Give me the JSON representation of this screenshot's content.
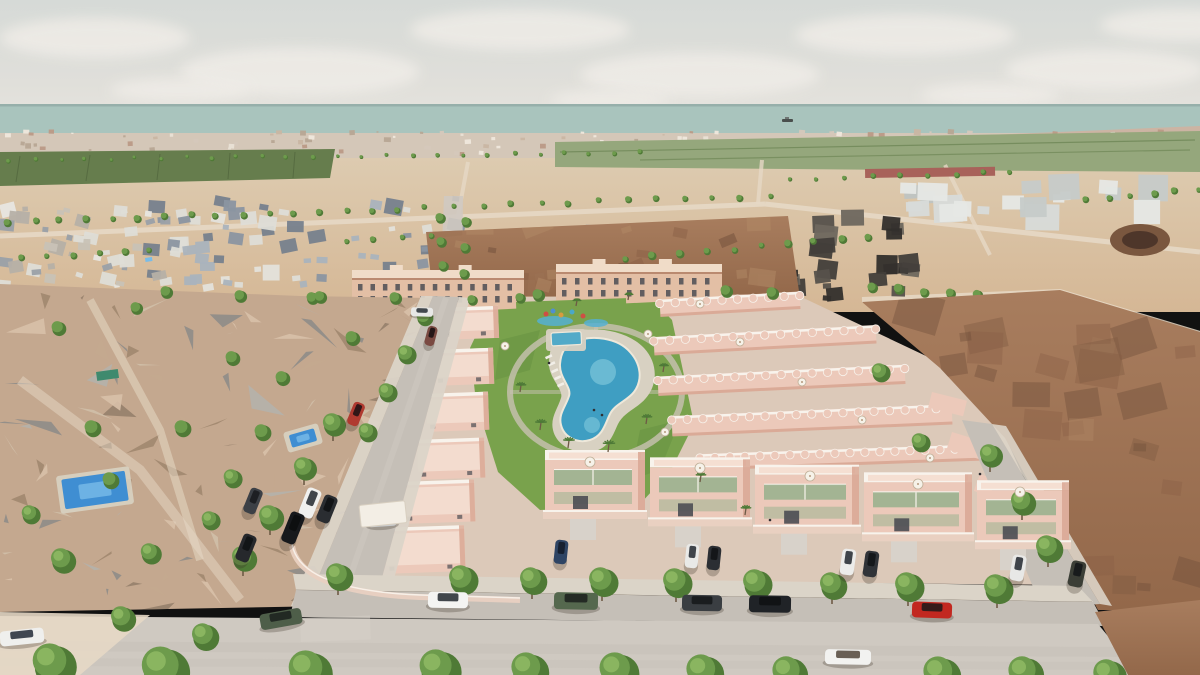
{
  "scene": {
    "type": "aerial-3d-render",
    "subject": "coastal residential development with lagoon pool, old town, sea horizon"
  },
  "palette": {
    "sky_top": "#d6dad7",
    "sky_bot": "#e9e6e0",
    "cloud": "#efece7",
    "sea": "#a9c4bd",
    "sea_dark": "#96afaa",
    "ship": "#4a4f4d",
    "town": "#d4c7b8",
    "hill": "#ccb4a3",
    "field": "#95a77c",
    "field_dark": "#6f8757",
    "orchard": "#667d4d",
    "orchard_dark": "#50643c",
    "sand_light": "#ddcbb0",
    "sand_mid": "#d5b795",
    "sand_road": "#e6d8c5",
    "warehouse": "#e6e8e5",
    "industrial": "#56514b",
    "redbldg": "#a8625a",
    "white_wall": "#deddd7",
    "grey_roof": "#8b95a1",
    "oldtown": "#c4a88f",
    "oldtown_light": "#d8c0a9",
    "oldtown_dark": "#a1876f",
    "pool_old": "#3f8ed2",
    "pool_old_light": "#79bce8",
    "lagoon": "#3f9ec2",
    "lagoon_light": "#8ed2e2",
    "pool_small": "#52aac8",
    "lawn": "#79a24c",
    "lawn_dark": "#5f8a3c",
    "palm": "#4e7a37",
    "villa": "#ecc9ba",
    "villa_light": "#f5dfd2",
    "villa_shade": "#d9a794",
    "villa_trim": "#f8f3ec",
    "shutter": "#9cb28f",
    "fence": "#e9d0c1",
    "apt": "#e3bfa5",
    "apt_roof": "#ba8a70",
    "apt_light": "#f0dcc8",
    "win": "#4b4c53",
    "path": "#c9c2b3",
    "deck": "#d8d1c2",
    "plate": "#dcc9b9",
    "road": "#c5bfb7",
    "road_light": "#cfc9c1",
    "road_pale": "#d8d2ca",
    "curb": "#6b5e50",
    "sidewalk": "#dbd4c8",
    "dirt": "#a87d5e",
    "dirt_dark": "#7d5940",
    "dirt_light": "#bb9573",
    "tree": "#6d9b4c",
    "tree_dark": "#4f7a36",
    "tree_light": "#8fba64",
    "trunk": "#6e5a45"
  },
  "sky": {
    "clouds": [
      {
        "x": 95,
        "y": 38,
        "rx": 95,
        "ry": 20
      },
      {
        "x": 300,
        "y": 72,
        "rx": 120,
        "ry": 24
      },
      {
        "x": 520,
        "y": 30,
        "rx": 110,
        "ry": 20
      },
      {
        "x": 700,
        "y": 75,
        "rx": 120,
        "ry": 22
      },
      {
        "x": 905,
        "y": 35,
        "rx": 110,
        "ry": 20
      },
      {
        "x": 1105,
        "y": 70,
        "rx": 100,
        "ry": 20
      },
      {
        "x": 1180,
        "y": 25,
        "rx": 80,
        "ry": 16
      },
      {
        "x": 180,
        "y": 90,
        "rx": 70,
        "ry": 12
      },
      {
        "x": 610,
        "y": 100,
        "rx": 60,
        "ry": 10
      },
      {
        "x": 990,
        "y": 95,
        "rx": 70,
        "ry": 12
      }
    ]
  },
  "sea": {
    "ship": {
      "x": 782,
      "y": 119
    }
  },
  "clusters": [
    {
      "layer": "town-cluster",
      "x": 0,
      "y": 131,
      "w": 1200,
      "h": 25,
      "count": 140,
      "smin": 2,
      "smax": 7,
      "rot": 6,
      "seed": 11,
      "op": 0.95,
      "colors": [
        "#e9e1d5",
        "#c9b6a2",
        "#bb9a86",
        "#efe8dc",
        "#b7a694",
        "#d5c8ba"
      ]
    },
    {
      "layer": "white-cluster",
      "x": 2,
      "y": 206,
      "w": 168,
      "h": 100,
      "count": 55,
      "smin": 5,
      "smax": 16,
      "rot": 18,
      "seed": 23,
      "op": 0.95,
      "colors": [
        "#deddd7",
        "#9aa0a8",
        "#c8c2b6",
        "#e8e6e0",
        "#b6b0a6"
      ]
    },
    {
      "layer": "greyL-cluster",
      "x": 150,
      "y": 198,
      "w": 310,
      "h": 96,
      "count": 70,
      "smin": 6,
      "smax": 18,
      "rot": 12,
      "seed": 5,
      "op": 0.95,
      "colors": [
        "#deddd7",
        "#8b95a1",
        "#aab3bd",
        "#e4e2db",
        "#77818d"
      ]
    },
    {
      "layer": "greyC-cluster",
      "x": 540,
      "y": 228,
      "w": 245,
      "h": 62,
      "count": 45,
      "smin": 6,
      "smax": 15,
      "rot": 10,
      "seed": 31,
      "op": 0.95,
      "colors": [
        "#8b95a1",
        "#deddd7",
        "#9aa3ae",
        "#e2e0d9"
      ]
    },
    {
      "layer": "industrial-cluster",
      "x": 778,
      "y": 212,
      "w": 134,
      "h": 92,
      "count": 26,
      "smin": 8,
      "smax": 26,
      "rot": 8,
      "seed": 41,
      "op": 0.95,
      "colors": [
        "#56514b",
        "#332f2c",
        "#6e675e",
        "#423e3a"
      ]
    },
    {
      "layer": "warehouse-cluster",
      "x": 880,
      "y": 184,
      "w": 312,
      "h": 36,
      "count": 22,
      "smin": 10,
      "smax": 34,
      "rot": 4,
      "seed": 53,
      "op": 0.95,
      "colors": [
        "#e6e8e5",
        "#c6cbc9",
        "#d8dbd9",
        "#bfc4c2"
      ]
    },
    {
      "layer": "dirthill-tex",
      "x": 430,
      "y": 222,
      "w": 360,
      "h": 74,
      "count": 26,
      "smin": 8,
      "smax": 30,
      "rot": 25,
      "seed": 67,
      "op": 0.5,
      "colors": [
        "#8a6045",
        "#6f4e39",
        "#b28a66",
        "#9b7154"
      ]
    },
    {
      "layer": "dirtfield-tex",
      "x": 880,
      "y": 310,
      "w": 320,
      "h": 300,
      "count": 40,
      "smin": 10,
      "smax": 46,
      "rot": 20,
      "seed": 79,
      "op": 0.4,
      "colors": [
        "#8a6045",
        "#6f4e39",
        "#b28a66",
        "#7d5940"
      ]
    }
  ],
  "oldtown": {
    "facets": {
      "count": 120,
      "seed": 97,
      "x": 0,
      "y": 288,
      "w": 440,
      "h": 326,
      "smin": 8,
      "smax": 26,
      "colors": [
        "#d8c0a9",
        "#a1876f",
        "#c4a88f",
        "#b5b1ab",
        "#8f8c88",
        "#d0bfa9",
        "#96806c"
      ]
    },
    "pools": [
      {
        "x": 95,
        "y": 490,
        "w": 64,
        "h": 30,
        "rot": -8
      },
      {
        "x": 303,
        "y": 438,
        "w": 26,
        "h": 13,
        "rot": -16
      }
    ],
    "awning": {
      "x": 96,
      "y": 372,
      "w": 22,
      "h": 9,
      "rot": -8
    }
  },
  "apartments": [
    {
      "x": 352,
      "y": 270,
      "w": 172,
      "rows": 2,
      "cols": 13
    },
    {
      "x": 556,
      "y": 264,
      "w": 166,
      "rows": 2,
      "cols": 12
    }
  ],
  "villa_rows": [
    {
      "x1": 660,
      "y1": 308,
      "x2": 800,
      "y2": 300,
      "w": 17
    },
    {
      "x1": 654,
      "y1": 346,
      "x2": 876,
      "y2": 334,
      "w": 18
    },
    {
      "x1": 658,
      "y1": 386,
      "x2": 905,
      "y2": 374,
      "w": 19
    },
    {
      "x1": 672,
      "y1": 426,
      "x2": 952,
      "y2": 414,
      "w": 20
    },
    {
      "x1": 700,
      "y1": 462,
      "x2": 985,
      "y2": 452,
      "w": 16
    }
  ],
  "left_villas": [
    {
      "x": 436,
      "y": 308,
      "w": 62,
      "h": 32
    },
    {
      "x": 429,
      "y": 350,
      "w": 64,
      "h": 36
    },
    {
      "x": 421,
      "y": 394,
      "w": 67,
      "h": 38
    },
    {
      "x": 412,
      "y": 440,
      "w": 72,
      "h": 40
    },
    {
      "x": 398,
      "y": 482,
      "w": 76,
      "h": 42
    },
    {
      "x": 380,
      "y": 528,
      "w": 84,
      "h": 46
    }
  ],
  "front_units": [
    {
      "x": 545,
      "w": 100
    },
    {
      "x": 650,
      "w": 100
    },
    {
      "x": 755,
      "w": 104
    },
    {
      "x": 864,
      "w": 108
    },
    {
      "x": 977,
      "w": 92
    }
  ],
  "cars": [
    {
      "x": 448,
      "y": 600,
      "w": 40,
      "h": 16,
      "rot": 1,
      "color": "#f4f4f2",
      "cab": "#2e3338"
    },
    {
      "x": 576,
      "y": 601,
      "w": 44,
      "h": 17,
      "rot": 1,
      "color": "#55684e",
      "cab": "#1f2420"
    },
    {
      "x": 702,
      "y": 603,
      "w": 40,
      "h": 16,
      "rot": 1,
      "color": "#3a3e42",
      "cab": "#17191c"
    },
    {
      "x": 770,
      "y": 604,
      "w": 42,
      "h": 17,
      "rot": 1,
      "color": "#202327",
      "cab": "#101214"
    },
    {
      "x": 932,
      "y": 610,
      "w": 40,
      "h": 16,
      "rot": 2,
      "color": "#c22820",
      "cab": "#26191a"
    },
    {
      "x": 848,
      "y": 657,
      "w": 46,
      "h": 15,
      "rot": 1,
      "color": "#f2f2f0",
      "cab": "#5a4f44"
    },
    {
      "x": 22,
      "y": 637,
      "w": 44,
      "h": 15,
      "rot": -6,
      "color": "#efefed",
      "cab": "#2c3440"
    },
    {
      "x": 281,
      "y": 619,
      "w": 42,
      "h": 16,
      "rot": -10,
      "color": "#4e5e49",
      "cab": "#1e241f"
    },
    {
      "x": 310,
      "y": 503,
      "w": 15,
      "h": 30,
      "rot": 22,
      "color": "#f0f0ee",
      "cab": "#2e3338"
    },
    {
      "x": 327,
      "y": 509,
      "w": 14,
      "h": 28,
      "rot": 22,
      "color": "#2a2d31",
      "cab": "#101214"
    },
    {
      "x": 293,
      "y": 528,
      "w": 15,
      "h": 32,
      "rot": 22,
      "color": "#17191c",
      "cab": "#0c0e10"
    },
    {
      "x": 253,
      "y": 501,
      "w": 13,
      "h": 26,
      "rot": 22,
      "color": "#3c4046",
      "cab": "#191c1f"
    },
    {
      "x": 246,
      "y": 548,
      "w": 14,
      "h": 28,
      "rot": 22,
      "color": "#26282c",
      "cab": "#111315"
    },
    {
      "x": 356,
      "y": 414,
      "w": 12,
      "h": 24,
      "rot": 22,
      "color": "#b03a30",
      "cab": "#241315"
    },
    {
      "x": 422,
      "y": 312,
      "w": 22,
      "h": 9,
      "rot": 2,
      "color": "#e8e8e6",
      "cab": "#30363c"
    },
    {
      "x": 431,
      "y": 336,
      "w": 10,
      "h": 20,
      "rot": 15,
      "color": "#7a4a42",
      "cab": "#1c1214"
    },
    {
      "x": 561,
      "y": 552,
      "w": 13,
      "h": 24,
      "rot": 6,
      "color": "#2e4464",
      "cab": "#141d2b"
    },
    {
      "x": 692,
      "y": 556,
      "w": 13,
      "h": 24,
      "rot": 6,
      "color": "#e9e9e7",
      "cab": "#2c3238"
    },
    {
      "x": 714,
      "y": 558,
      "w": 13,
      "h": 24,
      "rot": 6,
      "color": "#2b2e33",
      "cab": "#121416"
    },
    {
      "x": 848,
      "y": 562,
      "w": 14,
      "h": 26,
      "rot": 8,
      "color": "#ececea",
      "cab": "#2c3238"
    },
    {
      "x": 871,
      "y": 564,
      "w": 14,
      "h": 26,
      "rot": 8,
      "color": "#303338",
      "cab": "#131518"
    },
    {
      "x": 1018,
      "y": 568,
      "w": 14,
      "h": 26,
      "rot": 10,
      "color": "#e8e8e6",
      "cab": "#2c3238"
    },
    {
      "x": 1077,
      "y": 574,
      "w": 15,
      "h": 26,
      "rot": 12,
      "color": "#3b3e36",
      "cab": "#15171a"
    },
    {
      "x": 382,
      "y": 520,
      "w": 30,
      "h": 13,
      "rot": -4,
      "color": "#c9cbcd",
      "cab": "#2c3034"
    }
  ],
  "trees": {
    "rows": [
      {
        "x1": 8,
        "y1": 222,
        "x2": 425,
        "y2": 208,
        "n": 17,
        "r": 3.2
      },
      {
        "x1": 455,
        "y1": 206,
        "x2": 770,
        "y2": 196,
        "n": 12,
        "r": 2.8
      },
      {
        "x1": 625,
        "y1": 258,
        "x2": 868,
        "y2": 238,
        "n": 10,
        "r": 3.4
      },
      {
        "x1": 872,
        "y1": 288,
        "x2": 1030,
        "y2": 300,
        "n": 7,
        "r": 4.2
      },
      {
        "x1": 1030,
        "y1": 300,
        "x2": 1195,
        "y2": 338,
        "n": 7,
        "r": 4.6
      },
      {
        "x1": 1085,
        "y1": 200,
        "x2": 1198,
        "y2": 190,
        "n": 6,
        "r": 3
      },
      {
        "x1": 22,
        "y1": 258,
        "x2": 150,
        "y2": 250,
        "n": 6,
        "r": 3
      },
      {
        "x1": 790,
        "y1": 180,
        "x2": 1010,
        "y2": 172,
        "n": 9,
        "r": 2.4
      },
      {
        "x1": 345,
        "y1": 240,
        "x2": 430,
        "y2": 236,
        "n": 4,
        "r": 3
      },
      {
        "x1": 10,
        "y1": 160,
        "x2": 640,
        "y2": 152,
        "n": 26,
        "r": 2
      }
    ],
    "singles": [
      {
        "x": 338,
        "y": 576,
        "r": 13,
        "t": 1
      },
      {
        "x": 462,
        "y": 579,
        "r": 14,
        "t": 1
      },
      {
        "x": 532,
        "y": 580,
        "r": 13,
        "t": 1
      },
      {
        "x": 602,
        "y": 581,
        "r": 14,
        "t": 1
      },
      {
        "x": 676,
        "y": 582,
        "r": 14,
        "t": 1
      },
      {
        "x": 756,
        "y": 583,
        "r": 14,
        "t": 1
      },
      {
        "x": 832,
        "y": 585,
        "r": 13,
        "t": 1
      },
      {
        "x": 908,
        "y": 586,
        "r": 14,
        "t": 1
      },
      {
        "x": 997,
        "y": 588,
        "r": 14,
        "t": 1
      },
      {
        "x": 333,
        "y": 424,
        "r": 11,
        "t": 1
      },
      {
        "x": 304,
        "y": 468,
        "r": 11,
        "t": 1
      },
      {
        "x": 270,
        "y": 517,
        "r": 12,
        "t": 1
      },
      {
        "x": 243,
        "y": 558,
        "r": 12,
        "t": 1
      },
      {
        "x": 424,
        "y": 317,
        "r": 8
      },
      {
        "x": 406,
        "y": 354,
        "r": 9
      },
      {
        "x": 387,
        "y": 392,
        "r": 9
      },
      {
        "x": 367,
        "y": 432,
        "r": 9
      },
      {
        "x": 440,
        "y": 218,
        "r": 5
      },
      {
        "x": 441,
        "y": 242,
        "r": 5
      },
      {
        "x": 443,
        "y": 266,
        "r": 5
      },
      {
        "x": 466,
        "y": 222,
        "r": 5
      },
      {
        "x": 465,
        "y": 248,
        "r": 5
      },
      {
        "x": 464,
        "y": 274,
        "r": 5
      },
      {
        "x": 990,
        "y": 455,
        "r": 11,
        "t": 1
      },
      {
        "x": 1022,
        "y": 502,
        "r": 12,
        "t": 1
      },
      {
        "x": 1048,
        "y": 548,
        "r": 13,
        "t": 1
      },
      {
        "x": 920,
        "y": 442,
        "r": 9
      },
      {
        "x": 880,
        "y": 372,
        "r": 9
      },
      {
        "x": 538,
        "y": 295,
        "r": 6
      },
      {
        "x": 726,
        "y": 291,
        "r": 6
      },
      {
        "x": 772,
        "y": 293,
        "r": 6
      },
      {
        "x": 62,
        "y": 560,
        "r": 12
      },
      {
        "x": 122,
        "y": 618,
        "r": 12
      },
      {
        "x": 204,
        "y": 636,
        "r": 13
      },
      {
        "x": 30,
        "y": 514,
        "r": 9
      },
      {
        "x": 150,
        "y": 553,
        "r": 10
      },
      {
        "x": 232,
        "y": 478,
        "r": 9
      },
      {
        "x": 182,
        "y": 428,
        "r": 8
      },
      {
        "x": 92,
        "y": 428,
        "r": 8
      },
      {
        "x": 282,
        "y": 378,
        "r": 7
      },
      {
        "x": 352,
        "y": 338,
        "r": 7
      },
      {
        "x": 232,
        "y": 358,
        "r": 7
      },
      {
        "x": 312,
        "y": 298,
        "r": 6
      },
      {
        "x": 58,
        "y": 328,
        "r": 7
      },
      {
        "x": 136,
        "y": 308,
        "r": 6
      },
      {
        "x": 262,
        "y": 432,
        "r": 8
      },
      {
        "x": 210,
        "y": 520,
        "r": 9
      },
      {
        "x": 110,
        "y": 480,
        "r": 8
      },
      {
        "x": 166,
        "y": 292,
        "r": 6
      },
      {
        "x": 240,
        "y": 296,
        "r": 6
      },
      {
        "x": 320,
        "y": 297,
        "r": 6
      },
      {
        "x": 395,
        "y": 298,
        "r": 6
      },
      {
        "x": 472,
        "y": 300,
        "r": 5
      },
      {
        "x": 520,
        "y": 298,
        "r": 5
      }
    ],
    "front": [
      {
        "x": 52,
        "y": 664,
        "r": 21
      },
      {
        "x": 163,
        "y": 669,
        "r": 23
      },
      {
        "x": 308,
        "y": 671,
        "r": 21
      },
      {
        "x": 438,
        "y": 669,
        "r": 20
      },
      {
        "x": 528,
        "y": 670,
        "r": 18
      },
      {
        "x": 617,
        "y": 671,
        "r": 19
      },
      {
        "x": 703,
        "y": 672,
        "r": 18
      },
      {
        "x": 788,
        "y": 673,
        "r": 17
      },
      {
        "x": 940,
        "y": 674,
        "r": 18
      },
      {
        "x": 1024,
        "y": 673,
        "r": 17
      },
      {
        "x": 1108,
        "y": 675,
        "r": 16
      }
    ]
  },
  "palms": [
    {
      "x": 520,
      "y": 392,
      "s": 1
    },
    {
      "x": 540,
      "y": 430,
      "s": 1.1
    },
    {
      "x": 568,
      "y": 448,
      "s": 1.1
    },
    {
      "x": 608,
      "y": 452,
      "s": 1.2
    },
    {
      "x": 646,
      "y": 424,
      "s": 1
    },
    {
      "x": 663,
      "y": 372,
      "s": 0.9
    },
    {
      "x": 576,
      "y": 306,
      "s": 0.8
    },
    {
      "x": 628,
      "y": 300,
      "s": 0.8
    },
    {
      "x": 700,
      "y": 482,
      "s": 1
    },
    {
      "x": 745,
      "y": 515,
      "s": 1
    }
  ],
  "umbrellas": [
    {
      "x": 590,
      "y": 462,
      "r": 5
    },
    {
      "x": 700,
      "y": 468,
      "r": 5
    },
    {
      "x": 810,
      "y": 476,
      "r": 5
    },
    {
      "x": 918,
      "y": 484,
      "r": 5
    },
    {
      "x": 1020,
      "y": 492,
      "r": 5
    },
    {
      "x": 740,
      "y": 342,
      "r": 4
    },
    {
      "x": 802,
      "y": 382,
      "r": 4
    },
    {
      "x": 862,
      "y": 420,
      "r": 4
    },
    {
      "x": 700,
      "y": 304,
      "r": 4
    },
    {
      "x": 930,
      "y": 458,
      "r": 4
    },
    {
      "x": 665,
      "y": 432,
      "r": 4
    },
    {
      "x": 505,
      "y": 346,
      "r": 4
    },
    {
      "x": 648,
      "y": 334,
      "r": 4
    }
  ],
  "canopies": [
    {
      "x": 383,
      "y": 514,
      "w": 46,
      "h": 22,
      "rot": -6
    }
  ],
  "people": [
    {
      "x": 594,
      "y": 410
    },
    {
      "x": 602,
      "y": 415
    },
    {
      "x": 549,
      "y": 363
    },
    {
      "x": 980,
      "y": 474
    },
    {
      "x": 770,
      "y": 520
    }
  ],
  "splash": {
    "pools": [
      {
        "x": 555,
        "y": 321,
        "rx": 18,
        "ry": 5
      },
      {
        "x": 596,
        "y": 323,
        "rx": 12,
        "ry": 4
      }
    ],
    "dots": [
      {
        "x": 546,
        "y": 314,
        "c": "#cf4f43"
      },
      {
        "x": 553,
        "y": 311,
        "c": "#4f8fd0"
      },
      {
        "x": 561,
        "y": 315,
        "c": "#d89b3e"
      },
      {
        "x": 572,
        "y": 312,
        "c": "#4aa8c8"
      },
      {
        "x": 583,
        "y": 316,
        "c": "#cf4f43"
      }
    ]
  },
  "loungers": [
    {
      "x": 545,
      "y": 357
    },
    {
      "x": 548,
      "y": 364
    },
    {
      "x": 551,
      "y": 371
    },
    {
      "x": 554,
      "y": 378
    },
    {
      "x": 557,
      "y": 385
    }
  ]
}
